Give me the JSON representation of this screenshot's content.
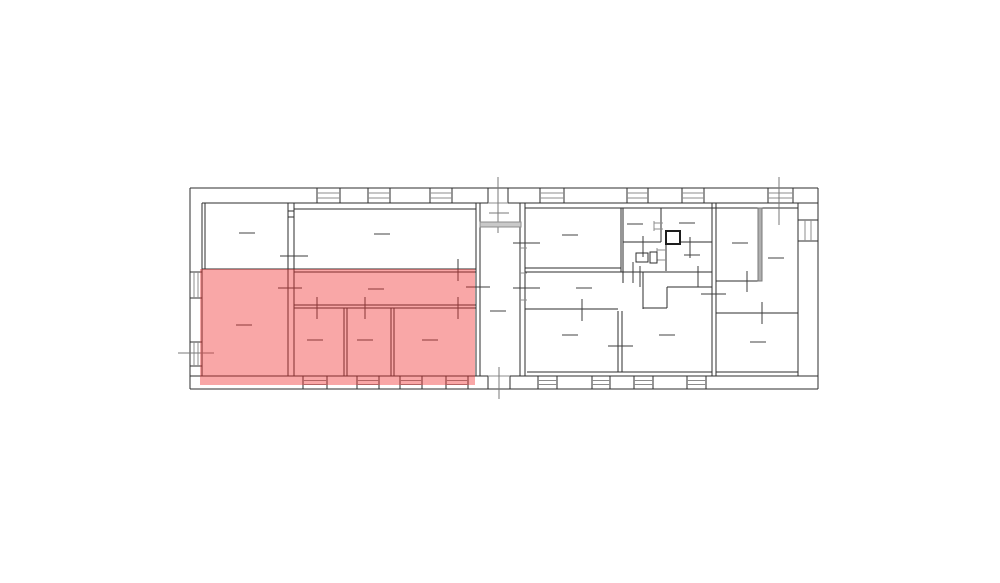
{
  "highlight": {
    "color": "#f02d2d",
    "opacity": 0.42,
    "x": 200,
    "y": 269,
    "width": 275,
    "height": 116
  },
  "floorplan": {
    "canvas": {
      "width": 1000,
      "height": 583
    },
    "colors": {
      "wall": "#2e2e2e",
      "detail": "#8c8c8c",
      "label_dash": "#434343",
      "marker": "#7a7a7a"
    },
    "walls": [
      [
        190,
        188,
        818,
        188
      ],
      [
        202,
        203,
        488,
        203
      ],
      [
        508,
        203,
        818,
        203
      ],
      [
        190,
        376,
        488,
        376
      ],
      [
        510,
        376,
        818,
        376
      ],
      [
        190,
        389,
        818,
        389
      ],
      [
        190,
        188,
        190,
        389
      ],
      [
        202,
        203,
        202,
        376
      ],
      [
        818,
        188,
        818,
        389
      ],
      [
        798,
        203,
        798,
        376
      ],
      [
        488,
        188,
        488,
        203
      ],
      [
        508,
        188,
        508,
        203
      ],
      [
        488,
        376,
        488,
        389
      ],
      [
        510,
        376,
        510,
        389
      ],
      [
        205,
        203,
        205,
        269
      ],
      [
        288,
        203,
        288,
        376
      ],
      [
        294,
        203,
        294,
        376
      ],
      [
        288,
        211,
        294,
        211
      ],
      [
        288,
        217,
        294,
        217
      ],
      [
        294,
        209,
        476,
        209
      ],
      [
        202,
        269,
        476,
        269
      ],
      [
        294,
        272,
        476,
        272
      ],
      [
        294,
        305,
        476,
        305
      ],
      [
        294,
        308,
        476,
        308
      ],
      [
        344,
        308,
        344,
        376
      ],
      [
        347,
        308,
        347,
        376
      ],
      [
        391,
        308,
        391,
        376
      ],
      [
        394,
        308,
        394,
        376
      ],
      [
        476,
        203,
        476,
        376
      ],
      [
        480,
        203,
        480,
        376
      ],
      [
        520,
        203,
        520,
        376
      ],
      [
        525,
        203,
        525,
        376
      ],
      [
        525,
        208,
        798,
        208
      ],
      [
        525,
        268,
        621,
        268
      ],
      [
        525,
        272,
        712,
        272
      ],
      [
        621,
        208,
        621,
        272
      ],
      [
        623,
        208,
        623,
        283
      ],
      [
        643,
        272,
        643,
        309
      ],
      [
        643,
        308,
        667,
        308
      ],
      [
        667,
        287,
        667,
        308
      ],
      [
        667,
        287,
        712,
        287
      ],
      [
        525,
        309,
        618,
        309
      ],
      [
        618,
        311,
        618,
        372
      ],
      [
        622,
        311,
        622,
        372
      ],
      [
        661,
        208,
        661,
        242
      ],
      [
        623,
        242,
        661,
        242
      ],
      [
        680,
        242,
        712,
        242
      ],
      [
        666,
        244,
        666,
        271
      ],
      [
        712,
        203,
        712,
        376
      ],
      [
        716,
        203,
        716,
        376
      ],
      [
        527,
        372,
        712,
        372
      ],
      [
        716,
        281,
        758,
        281
      ],
      [
        758,
        208,
        758,
        281
      ],
      [
        762,
        208,
        762,
        281
      ],
      [
        716,
        313,
        798,
        313
      ],
      [
        716,
        372,
        798,
        372
      ],
      [
        666,
        231,
        680,
        244
      ],
      [
        680,
        231,
        666,
        244
      ]
    ],
    "windows": [
      {
        "side": "top",
        "from": 317,
        "to": 340
      },
      {
        "side": "top",
        "from": 368,
        "to": 390
      },
      {
        "side": "top",
        "from": 430,
        "to": 452
      },
      {
        "side": "top",
        "from": 540,
        "to": 564
      },
      {
        "side": "top",
        "from": 627,
        "to": 648
      },
      {
        "side": "top",
        "from": 682,
        "to": 704
      },
      {
        "side": "top",
        "from": 768,
        "to": 793
      },
      {
        "side": "bottom",
        "from": 303,
        "to": 327
      },
      {
        "side": "bottom",
        "from": 357,
        "to": 379
      },
      {
        "side": "bottom",
        "from": 400,
        "to": 422
      },
      {
        "side": "bottom",
        "from": 446,
        "to": 468
      },
      {
        "side": "bottom",
        "from": 538,
        "to": 557
      },
      {
        "side": "bottom",
        "from": 592,
        "to": 610
      },
      {
        "side": "bottom",
        "from": 634,
        "to": 653
      },
      {
        "side": "bottom",
        "from": 687,
        "to": 706
      },
      {
        "side": "left",
        "from": 272,
        "to": 298
      },
      {
        "side": "left",
        "from": 342,
        "to": 366
      },
      {
        "side": "right",
        "from": 220,
        "to": 241
      }
    ],
    "window_sides": {
      "top": {
        "a": 188,
        "b": 203,
        "mids": [
          193,
          198
        ],
        "horizontal": true
      },
      "bottom": {
        "a": 376,
        "b": 389,
        "mids": [
          380.5,
          384.5
        ],
        "horizontal": true
      },
      "left": {
        "a": 190,
        "b": 202,
        "mids": [
          194,
          198
        ],
        "horizontal": false
      },
      "right": {
        "a": 798,
        "b": 818,
        "mids": [
          805,
          811
        ],
        "horizontal": false
      }
    },
    "door_ticks": [
      [
        317,
        297,
        317,
        319
      ],
      [
        365,
        297,
        365,
        319
      ],
      [
        458,
        297,
        458,
        319
      ],
      [
        458,
        259,
        458,
        281
      ],
      [
        278,
        288,
        302,
        288
      ],
      [
        280,
        256,
        308,
        256
      ],
      [
        466,
        287,
        490,
        287
      ],
      [
        513,
        243,
        540,
        243
      ],
      [
        513,
        288,
        540,
        288
      ],
      [
        582,
        299,
        582,
        321
      ],
      [
        608,
        346,
        633,
        346
      ],
      [
        643,
        236,
        643,
        257
      ],
      [
        690,
        237,
        690,
        258
      ],
      [
        640,
        266,
        640,
        287
      ],
      [
        698,
        266,
        698,
        287
      ],
      [
        633,
        262,
        633,
        283
      ],
      [
        701,
        294,
        726,
        294
      ],
      [
        747,
        271,
        747,
        292
      ],
      [
        762,
        302,
        762,
        324
      ]
    ],
    "markers": [
      [
        498,
        177,
        498,
        233
      ],
      [
        489,
        213,
        509,
        213
      ],
      [
        779,
        177,
        779,
        225
      ],
      [
        499,
        367,
        499,
        399
      ],
      [
        178,
        353,
        214,
        353
      ]
    ],
    "detail_lines": [
      [
        488,
        203,
        508,
        203
      ],
      [
        488,
        376,
        510,
        376
      ],
      [
        520,
        248,
        527,
        248
      ],
      [
        520,
        273,
        527,
        273
      ],
      [
        520,
        300,
        527,
        300
      ],
      [
        654,
        221,
        654,
        231
      ],
      [
        654,
        223,
        663,
        223
      ],
      [
        654,
        229,
        663,
        229
      ],
      [
        657,
        248,
        657,
        262
      ],
      [
        657,
        250,
        666,
        250
      ],
      [
        657,
        260,
        666,
        260
      ]
    ],
    "label_dashes": [
      [
        247,
        233
      ],
      [
        382,
        234
      ],
      [
        244,
        325
      ],
      [
        376,
        289
      ],
      [
        315,
        340
      ],
      [
        365,
        340
      ],
      [
        430,
        340
      ],
      [
        498,
        311
      ],
      [
        570,
        235
      ],
      [
        584,
        288
      ],
      [
        570,
        335
      ],
      [
        667,
        335
      ],
      [
        635,
        224
      ],
      [
        687,
        223
      ],
      [
        692,
        255
      ],
      [
        740,
        243
      ],
      [
        776,
        258
      ],
      [
        758,
        342
      ]
    ],
    "gray_walls": [
      {
        "x": 758,
        "y": 208,
        "w": 4,
        "h": 73
      }
    ],
    "landing": {
      "x": 480,
      "y": 222,
      "w": 41,
      "h": 5
    },
    "shaft_box": {
      "x": 666,
      "y": 231,
      "w": 14,
      "h": 13
    },
    "fixtures": [
      {
        "x": 636,
        "y": 253,
        "w": 12,
        "h": 9
      },
      {
        "x": 650,
        "y": 252,
        "w": 7,
        "h": 11
      }
    ]
  }
}
